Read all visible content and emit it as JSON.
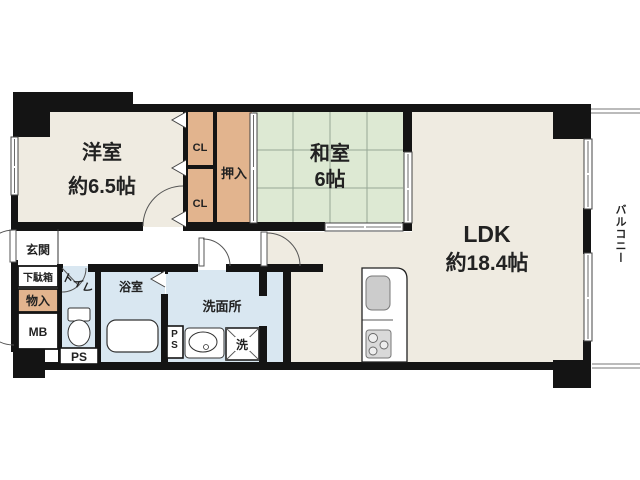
{
  "plan": {
    "type": "apartment-floorplan",
    "rooms": {
      "yoshitsu": {
        "label": "洋室",
        "size": "約6.5帖"
      },
      "washitsu": {
        "label": "和室",
        "size": "6帖"
      },
      "ldk": {
        "label": "LDK",
        "size": "約18.4帖"
      },
      "genkan": {
        "label": "玄関"
      },
      "getabako": {
        "label": "下駄箱"
      },
      "monoire": {
        "label": "物入"
      },
      "mb": {
        "label": "MB"
      },
      "toilet": {
        "label": "トイレ"
      },
      "ps_toilet": {
        "label": "PS"
      },
      "bath": {
        "label": "浴室"
      },
      "senmenjo": {
        "label": "洗面所"
      },
      "ps_senmenjo": {
        "label": "PS"
      },
      "washer": {
        "label": "洗"
      },
      "cl_upper": {
        "label": "CL"
      },
      "cl_lower": {
        "label": "CL"
      },
      "oshiire": {
        "label": "押入"
      },
      "balcony": {
        "label": "バルコニー"
      }
    },
    "colors": {
      "floor": "#EFEBE1",
      "tatami": "#DDE9D3",
      "closet": "#E2B48E",
      "wet_area": "#D9E7F1",
      "wall": "#141414",
      "grid_line": "#96A896",
      "door_line": "#555555"
    }
  }
}
